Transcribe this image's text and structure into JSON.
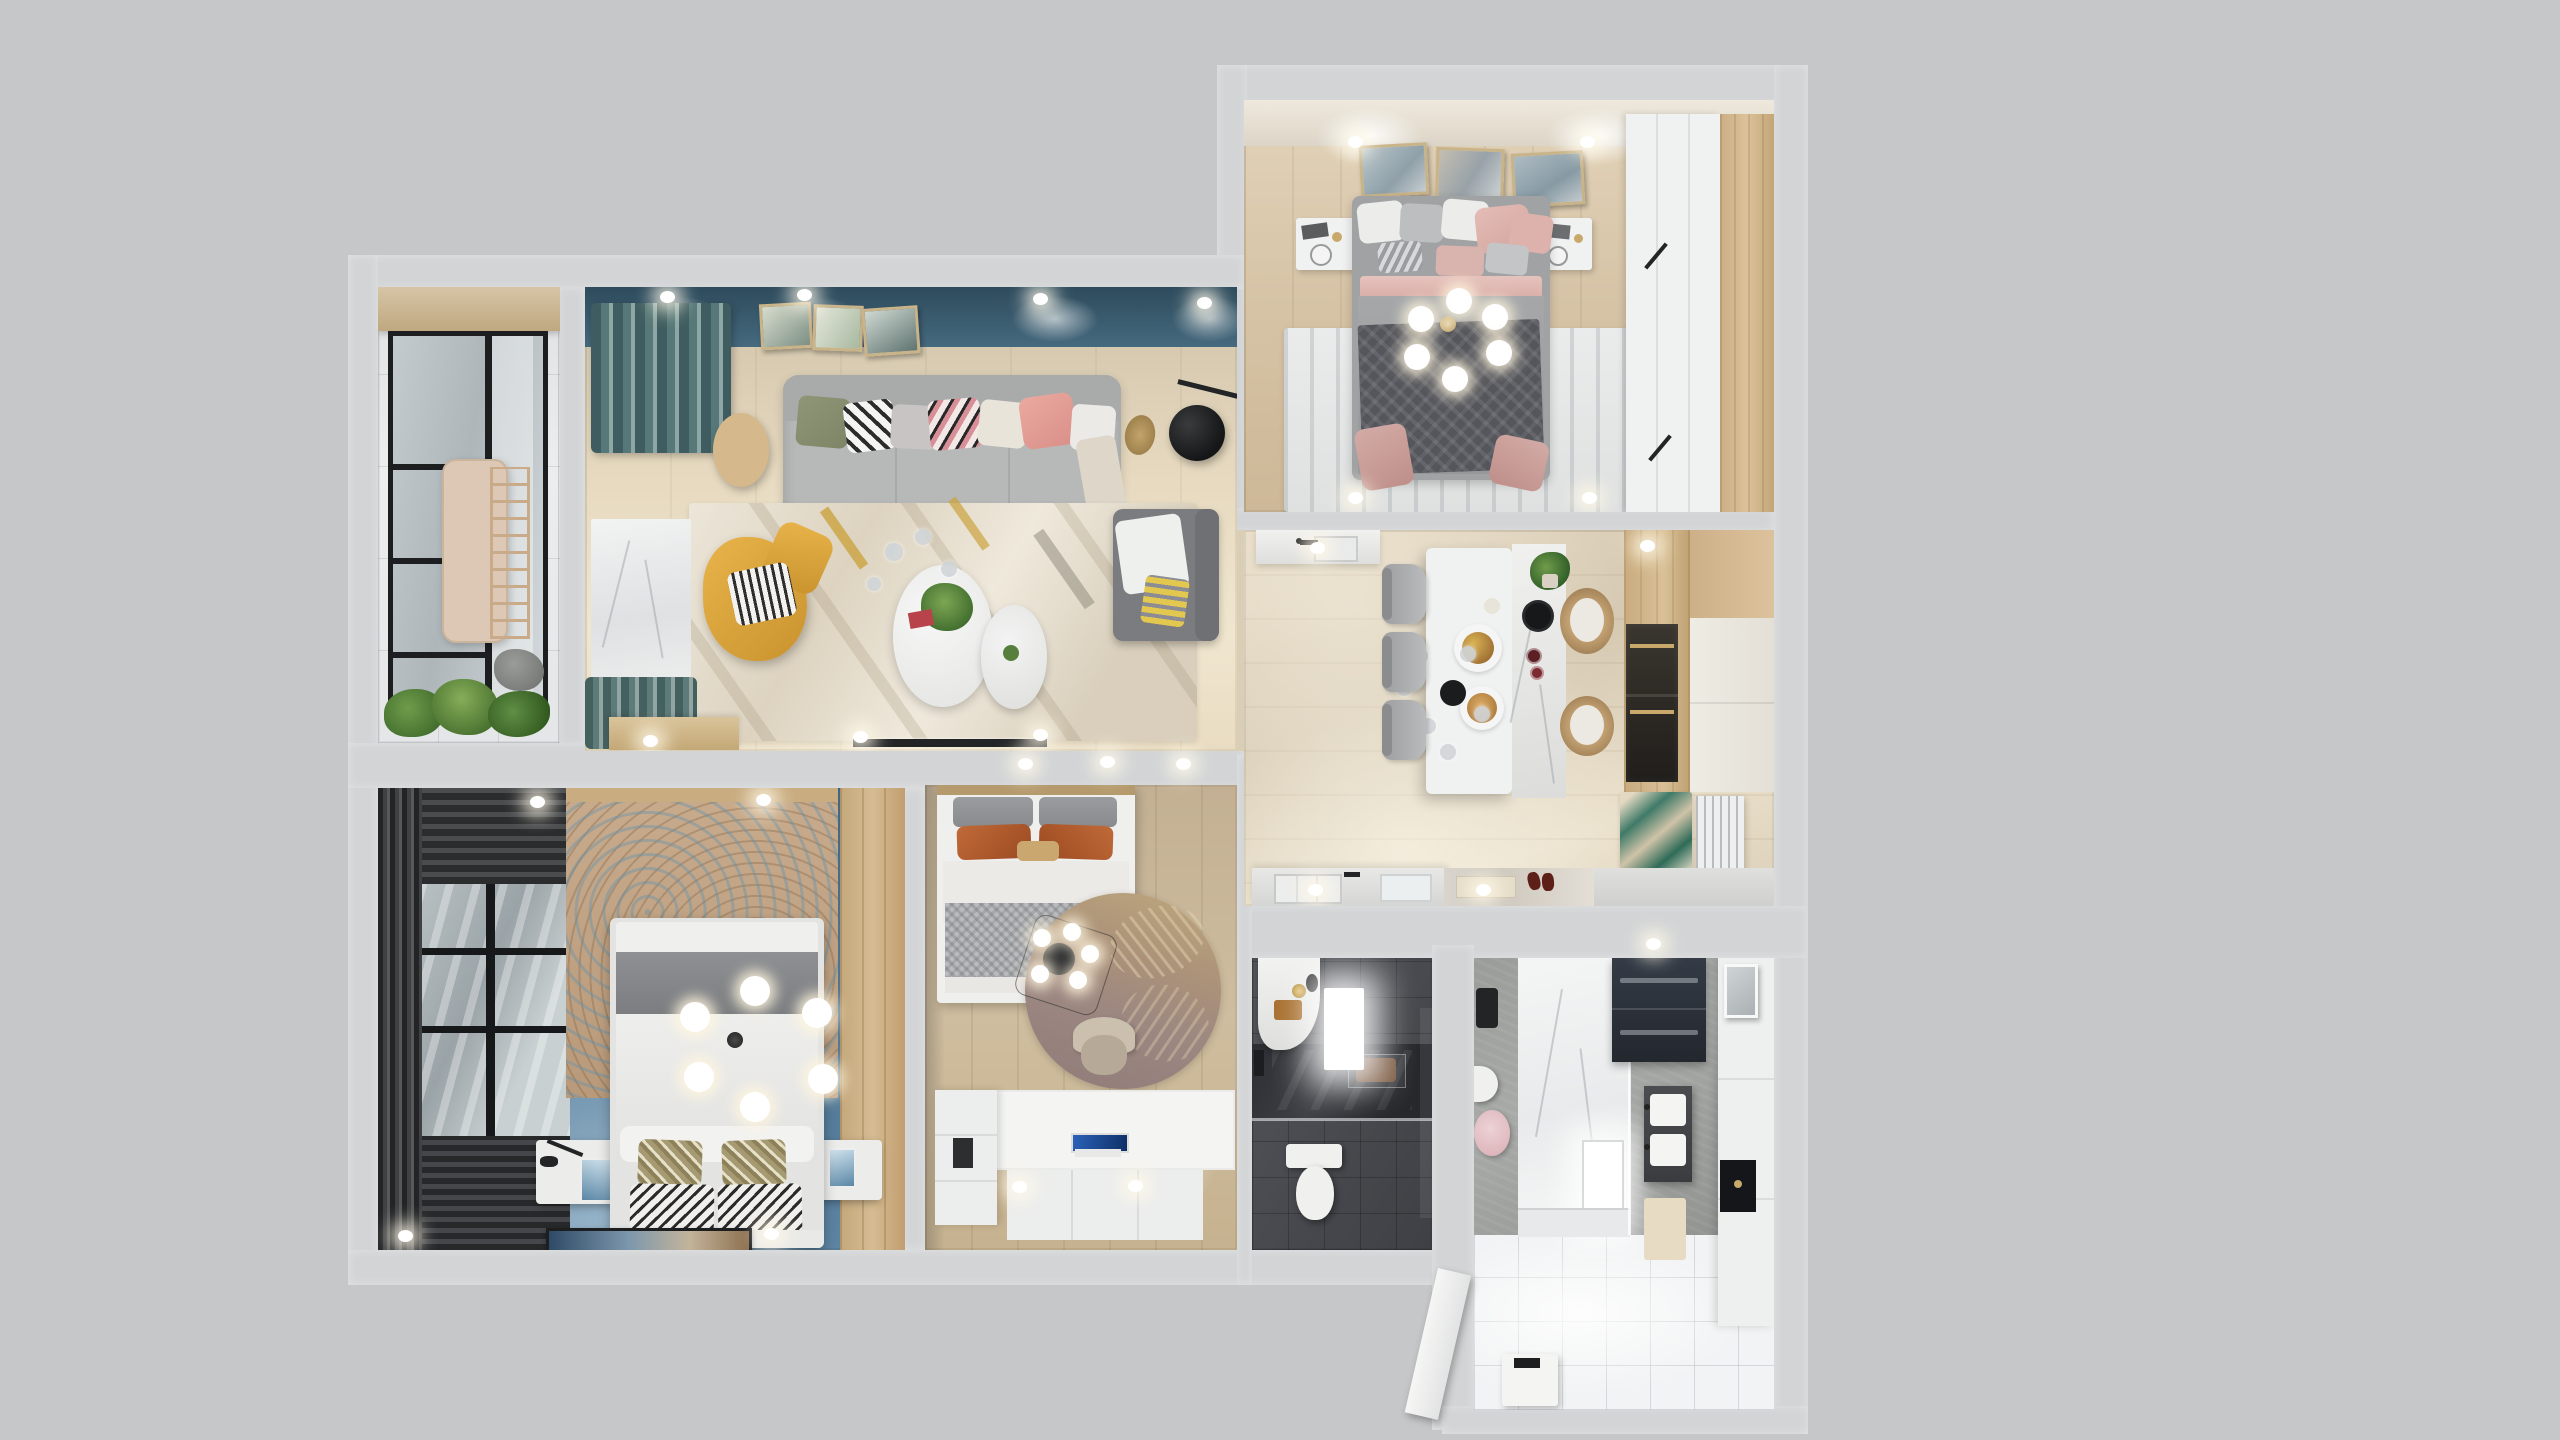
{
  "scene": {
    "type": "3d-floorplan-top-down-render",
    "description": "Photoreal top-down 3D render of a furnished apartment floor plan centered on a plain gray backdrop",
    "canvas": {
      "width": 2560,
      "height": 1440
    },
    "lighting": "recessed white ceiling spotlights glowing along walls"
  },
  "palette": {
    "bg_canvas": "#c6c7c9",
    "wall": "#d2d4d6",
    "teal_wall": "#3a6076",
    "curtain_teal": "#4d6b6e",
    "master_blue": "#48708e",
    "wood_living": "#ddd0b7",
    "wood_kitchen": "#dbceb7",
    "wood_top_bedroom": "#d9c7ab",
    "wood_small_bedroom": "#c9b698",
    "wood_panel": "#c9ac80",
    "marble": "#eceeee",
    "sofa": "#b7b9b9",
    "chaise": "#7a7c7f",
    "yellow": "#dca63e",
    "rug_cream": "#e7e1d4",
    "rug_gray": "#e4e5e5",
    "bed_white": "#efefed",
    "duvet_gray": "#a0a2a4",
    "blanket_gray": "#85878a",
    "throw_dark": "#55565c",
    "pink": "#d8b5b1",
    "rust": "#b05c30",
    "olive": "#99916f",
    "headboard_tan": "#c2a585",
    "feather_mauve": "#a28d88",
    "dark_bath": "#4e5056",
    "shower_dark": "#35373c",
    "concrete": "#9da09e",
    "tile_white": "#f2f3f4",
    "appliance": "#2e333c",
    "white_f": "#f0f1f1",
    "black": "#232426",
    "glass": "#b3bbbf",
    "window_dark": "#3a3c3e",
    "plant": "#567f3d",
    "gold": "#c9a96b",
    "shoe": "#5c2018"
  },
  "rooms": [
    {
      "id": "living-room",
      "furniture": [
        "teal accent wall with 3 art frames",
        "gray 3-seat sofa with multicolor pillows",
        "teal curtains",
        "round wood side table",
        "yellow armchair with striped pillow",
        "nesting white coffee tables with plant",
        "cream streaked area rug",
        "gray chaise with blankets",
        "black arc floor lamp",
        "wood TV console",
        "wall TV strip"
      ]
    },
    {
      "id": "balcony",
      "furniture": [
        "marble floor",
        "black framed glazing",
        "hanging drying rack",
        "planter greenery",
        "rock"
      ]
    },
    {
      "id": "master-bedroom",
      "furniture": [
        "blue floor",
        "double bed with gray band and patterned pillows",
        "mottled tan headboard rug",
        "white nightstands with lamps",
        "sputnik globe chandelier",
        "dark window blinds and curtains",
        "wood wardrobe panel",
        "striped runner art"
      ]
    },
    {
      "id": "kids-bedroom",
      "furniture": [
        "single bed with rust pillows",
        "round feather rug",
        "geometric pendant lamp",
        "desk chair",
        "lit desk with laptop",
        "white wardrobe"
      ]
    },
    {
      "id": "kitchen-dining",
      "furniture": [
        "white island with marble bar",
        "black hob circle",
        "food plates",
        "three gray dining chairs",
        "two rattan stools",
        "black pendant with glass globes",
        "wood and white cabinetry",
        "dark wall ovens",
        "sink counters",
        "entry bench with shoes",
        "green accent rug",
        "white radiator"
      ]
    },
    {
      "id": "bathroom-dark",
      "furniture": [
        "dark tile floor",
        "white vanity with gold accessories",
        "glowing mirror light",
        "dark marble walk-in shower",
        "towel rail",
        "white toilet"
      ]
    },
    {
      "id": "bathroom-laundry",
      "furniture": [
        "concrete floor",
        "white marble shower with light panel",
        "washer-dryer stack",
        "tall white storage column with niche",
        "dark double-sink vanity",
        "cream mat",
        "pink basin",
        "white toilet",
        "storage bench",
        "open white entry door"
      ]
    }
  ]
}
